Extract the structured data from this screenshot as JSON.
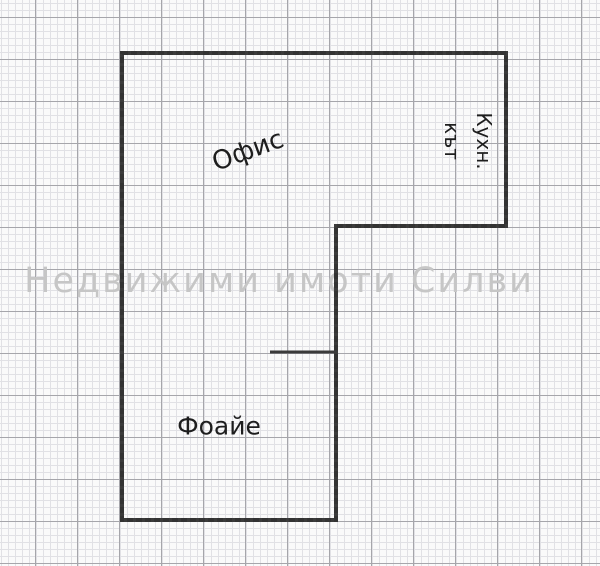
{
  "canvas": {
    "width_px": 600,
    "height_px": 566,
    "description": "Real-estate floor plan sketch on graph paper"
  },
  "watermark": {
    "text": "Недвижими имоти Силви"
  },
  "rooms": {
    "office": {
      "label": "Офис"
    },
    "kitchen_nook": {
      "line1": "Кухн.",
      "line2": "кът"
    },
    "foyer": {
      "label": "Фоайе"
    }
  },
  "colors": {
    "paper": "#fafafa",
    "grid_minor": "#e1e1e5",
    "grid_major": "#a6a6ab",
    "wall": "#3b3b3b",
    "wall_texture": "#2b2b2b",
    "label_text": "#1e1e1e",
    "watermark": "#c6c6c6"
  }
}
